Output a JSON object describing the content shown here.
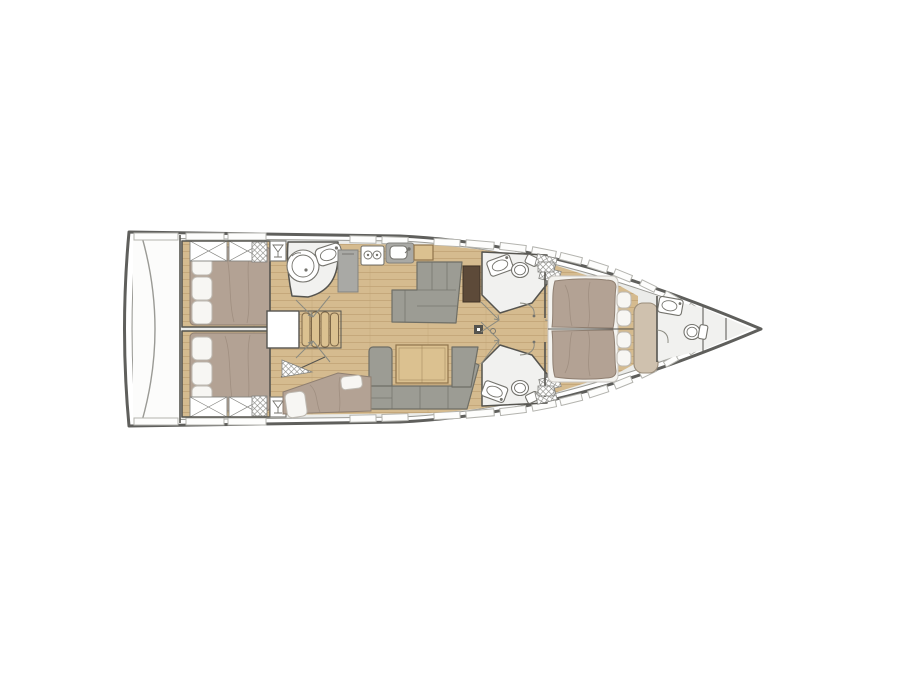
{
  "meta": {
    "type": "yacht-interior-floor-plan",
    "view": "top-down",
    "orientation": "bow-right",
    "visible_text": "none"
  },
  "colors": {
    "hull_outline": "#5f5f5c",
    "hull_inner": "#9a9a95",
    "deck": "#ebecea",
    "transom": "#fcfcfb",
    "wood": "#d5bb8f",
    "woodline": "#b99c6c",
    "mattress": "#b3a294",
    "mshade": "#8f7f71",
    "pillow": "#f7f6f3",
    "pstroke": "#bdb8b0",
    "sofa": "#9c9c94",
    "sofaline": "#6e6e66",
    "tablewood": "#dbc190",
    "woodedge": "#8f744c",
    "darktable": "#5d4a39",
    "gray": "#a9a9a5",
    "graydark": "#83837f",
    "bath": "#f1f1ef",
    "wall": "#55544f",
    "fix": "#74736d",
    "white": "#ffffff",
    "window": "#fdfdfc",
    "winstroke": "#b3b3ae",
    "arc": "#8a8a80",
    "hatchline": "#8a8a85"
  },
  "areas": [
    {
      "name": "swim-platform",
      "position": "stern"
    },
    {
      "name": "aft-cabin-port",
      "features": [
        "double-berth",
        "pillows",
        "x-storage-lockers"
      ]
    },
    {
      "name": "aft-cabin-starboard",
      "features": [
        "double-berth",
        "pillows",
        "x-storage-lockers"
      ]
    },
    {
      "name": "aft-head",
      "features": [
        "round-shower",
        "washbasin",
        "door-swing"
      ]
    },
    {
      "name": "galley",
      "features": [
        "refrigerator",
        "two-burner-stove",
        "sink"
      ]
    },
    {
      "name": "companionway",
      "features": [
        "engine-hatch",
        "stairs-4-treads"
      ]
    },
    {
      "name": "salon",
      "features": [
        "l-settee",
        "chart-table",
        "u-sofa",
        "dining-table",
        "mast-post"
      ]
    },
    {
      "name": "skipper-berth-aft",
      "features": [
        "single-berth",
        "pillows",
        "hanging-locker"
      ]
    },
    {
      "name": "mid-head-port",
      "features": [
        "washbasin",
        "toilet",
        "louvered-lockers"
      ]
    },
    {
      "name": "mid-head-starboard",
      "features": [
        "washbasin",
        "toilet",
        "louvered-lockers"
      ]
    },
    {
      "name": "owner-cabin-forward",
      "features": [
        "island-double-berth",
        "side-shelves",
        "bench-seat"
      ]
    },
    {
      "name": "bow-head",
      "features": [
        "washbasin",
        "toilet"
      ]
    },
    {
      "name": "anchor-locker",
      "position": "bow"
    }
  ]
}
